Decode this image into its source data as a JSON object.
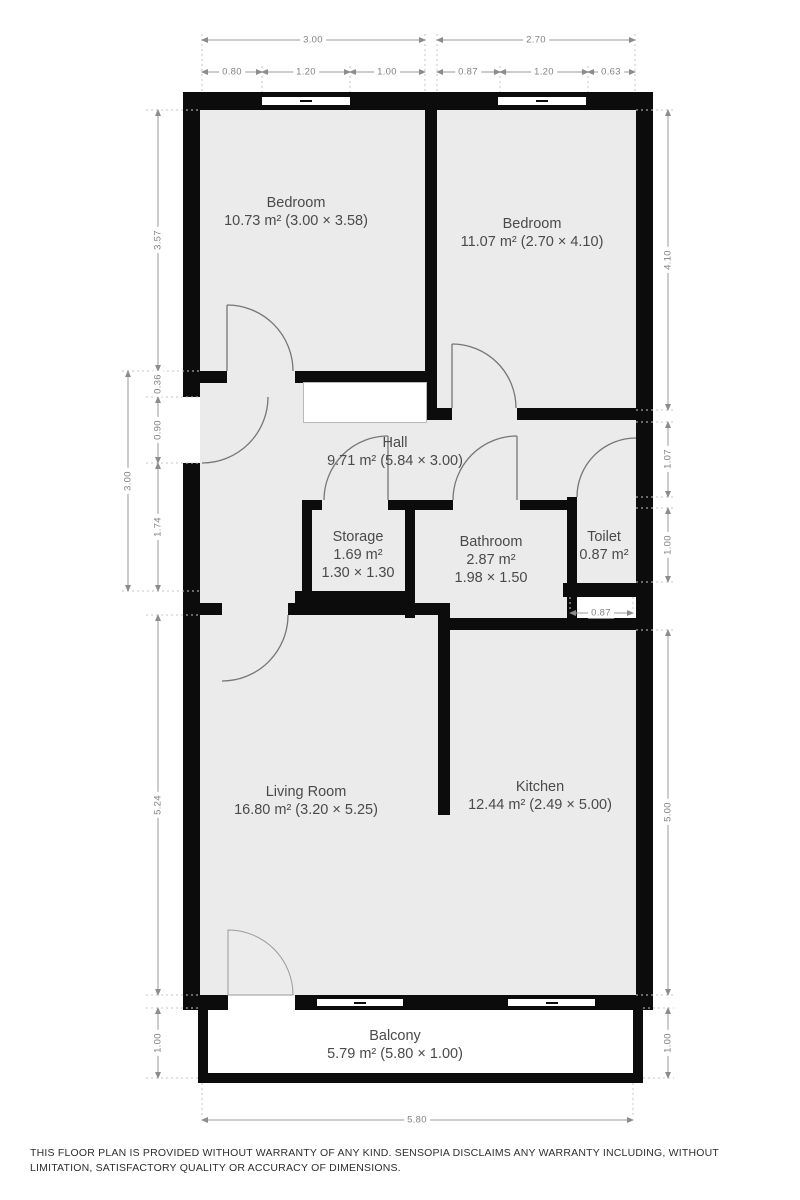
{
  "rooms": [
    {
      "name": "Bedroom",
      "area": "10.73 m² (3.00 × 3.58)"
    },
    {
      "name": "Bedroom",
      "area": "11.07 m² (2.70 × 4.10)"
    },
    {
      "name": "Hall",
      "area": "9.71 m² (5.84 × 3.00)"
    },
    {
      "name": "Storage",
      "area": "1.69 m²",
      "size": "1.30 × 1.30"
    },
    {
      "name": "Bathroom",
      "area": "2.87 m²",
      "size": "1.98 × 1.50"
    },
    {
      "name": "Toilet",
      "area": "0.87 m²"
    },
    {
      "name": "Living Room",
      "area": "16.80 m² (3.20 × 5.25)"
    },
    {
      "name": "Kitchen",
      "area": "12.44 m² (2.49 × 5.00)"
    },
    {
      "name": "Balcony",
      "area": "5.79 m² (5.80 × 1.00)"
    }
  ],
  "dims": {
    "top_totals": [
      "3.00",
      "2.70"
    ],
    "top_subs": [
      "0.80",
      "1.20",
      "1.00",
      "0.87",
      "1.20",
      "0.63"
    ],
    "left": [
      "3.57",
      "0.36",
      "0.90",
      "1.74",
      "3.00",
      "5.24",
      "1.00"
    ],
    "right": [
      "4.10",
      "1.07",
      "1.00",
      "0.87",
      "5.00",
      "1.00"
    ],
    "bottom": [
      "5.80"
    ]
  },
  "disclaimer": "THIS FLOOR PLAN IS PROVIDED WITHOUT WARRANTY OF ANY KIND. SENSOPIA DISCLAIMS ANY WARRANTY INCLUDING, WITHOUT LIMITATION, SATISFACTORY QUALITY OR ACCURACY OF DIMENSIONS.",
  "colors": {
    "wall": "#0c0c0c",
    "floor": "#ebebeb",
    "dim_line": "#9a9a9a",
    "dim_text": "#828282",
    "label_text": "#4a4a4a"
  }
}
